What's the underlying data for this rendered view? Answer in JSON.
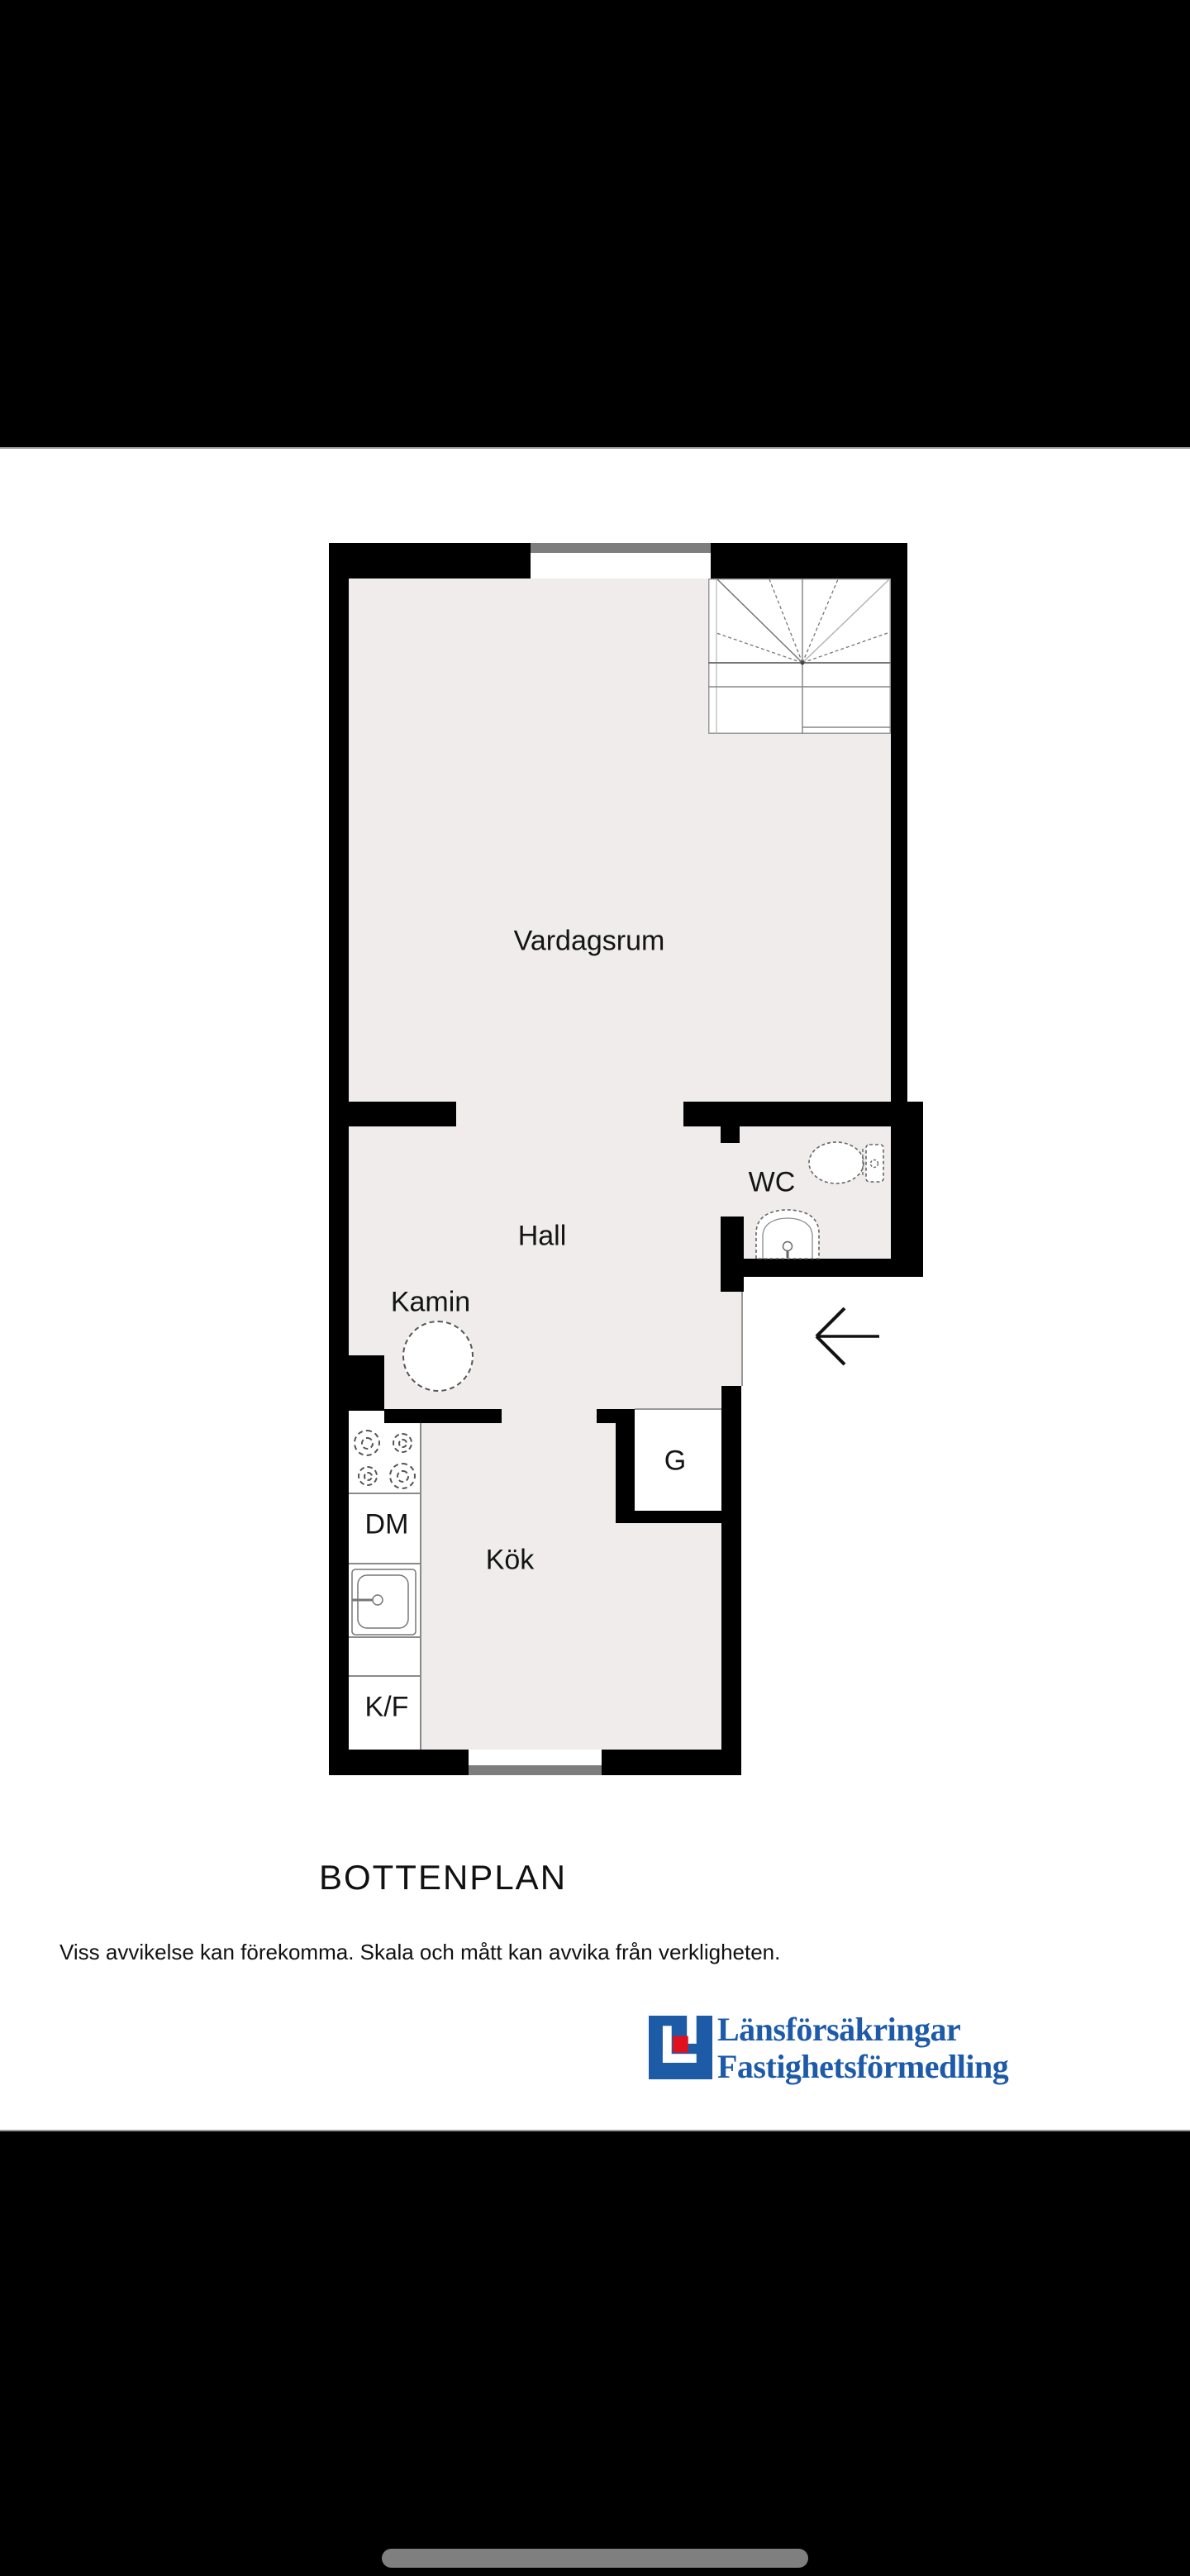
{
  "plan": {
    "rooms": {
      "living_room": "Vardagsrum",
      "hall": "Hall",
      "wc": "WC",
      "kitchen": "Kök",
      "fireplace": "Kamin",
      "closet": "G",
      "dishwasher": "DM",
      "fridge_freezer": "K/F"
    },
    "floor_color": "#efeceb",
    "wall_color": "#000000"
  },
  "caption": {
    "title": "BOTTENPLAN",
    "disclaimer": "Viss avvikelse kan förekomma. Skala och mått kan avvika från verkligheten."
  },
  "logo": {
    "line1": "Länsförsäkringar",
    "line2": "Fastighetsförmedling",
    "blue": "#1d5aa8",
    "red": "#e0111c"
  }
}
